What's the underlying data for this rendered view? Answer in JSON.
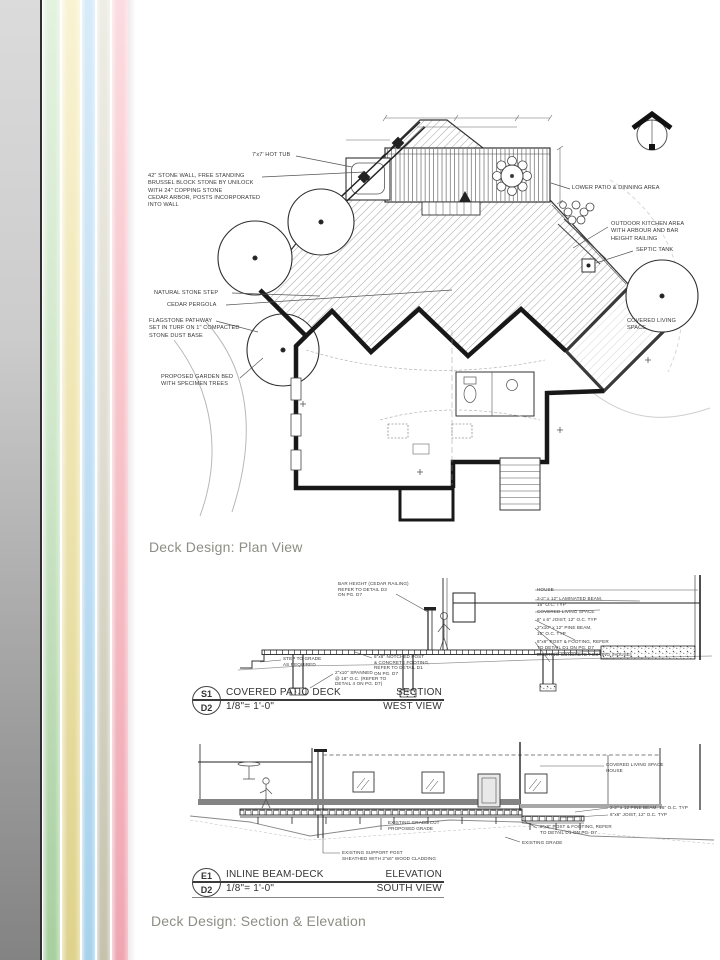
{
  "slide": {
    "background": "#ffffff"
  },
  "sidebar": {
    "panel_top_color": "#dbdbdb",
    "panel_bottom_color": "#838383",
    "divider_color": "#2f2f2f",
    "stripes": [
      {
        "name": "green",
        "top": "#e4f2e0",
        "bottom": "#a8cfa0"
      },
      {
        "name": "yellow",
        "top": "#f9f3d3",
        "bottom": "#ded28c"
      },
      {
        "name": "blue",
        "top": "#d8ebf8",
        "bottom": "#a8d2ec"
      },
      {
        "name": "beige",
        "top": "#eeede5",
        "bottom": "#c6c2ae"
      },
      {
        "name": "pink",
        "top": "#fbdce0",
        "bottom": "#efa6b2"
      }
    ]
  },
  "captions": {
    "plan": "Deck Design: Plan View",
    "section_elevation": "Deck Design: Section & Elevation",
    "color": "#8d8d85"
  },
  "plan_view": {
    "labels": {
      "hot_tub": "7'x7' HOT TUB",
      "stone_wall": "42\" STONE WALL, FREE STANDING\nBRUSSEL BLOCK STONE BY UNILOCK\nWITH 24\" COPPING STONE\nCEDAR ARBOR, POSTS INCORPORATED\nINTO WALL",
      "natural_stone_step": "NATURAL STONE STEP",
      "cedar_pergola": "CEDAR PERGOLA",
      "flagstone_pathway": "FLAGSTONE PATHWAY\nSET IN TURF ON 1\" COMPACTED\nSTONE DUST BASE",
      "garden_bed": "PROPOSED GARDEN BED\nWITH SPECIMEN TREES",
      "lower_patio": "LOWER PATIO & DINNING AREA",
      "outdoor_kitchen": "OUTDOOR KITCHEN AREA\nWITH ARBOUR AND BAR\nHEIGHT RAILING",
      "septic_tank": "SEPTIC TANK",
      "covered_living": "COVERED LIVING\nSPACE"
    }
  },
  "section_view": {
    "labels": {
      "railing": "BAR HEIGHT (CEDAR RAILING)\nREFER TO DETAIL D3\nON PG. D7",
      "step_to_grade": "STEP TO GRADE\nAS REQUIRED",
      "spans": "2\"x10\" SPANNED\n@ 16\" O.C. (REFER TO\nDETAIL 4 ON PG. D7)",
      "notched_post": "6\"x6\" NOTCHED POST\n& CONCRETE FOOTING,\nREFER TO DETAIL D1\nON PG. D7",
      "house": "HOUSE",
      "laminated_beam": "2-2\" x 12\" LAMINATED BEAM,\n16\" O.C. TYP",
      "covered_living_space": "COVERED LIVING SPACE",
      "joist": "6\" x 6\" JOIST, 12\" O.C. TYP",
      "pine_beam": "2\"x10\" x 12\" PINE BEAM,\n16\" O.C. TYP",
      "post_footing": "6\"x6\" POST & FOOTING, REFER\nTO DETAIL D1 ON PG. D7",
      "concrete_footing": "EXISTING CONCRETE FOOTING (HOUSE)"
    },
    "title_block": {
      "drawing_ref": "S1",
      "sheet_ref": "D2",
      "title": "COVERED PATIO DECK",
      "scale": "1/8\"= 1'-0\"",
      "type": "SECTION",
      "view": "WEST VIEW"
    }
  },
  "elevation_view": {
    "labels": {
      "covered_living_house": "COVERED LIVING SPACE\nHOUSE",
      "pine_beam": "2-2\" x 12 PINE BEAM, 16\" O.C. TYP",
      "joist": "6\"x6\" JOIST, 12\" O.C. TYP",
      "post_footing": "6\"x6\" POST & FOOTING, REFER\nTO DETAIL D1 ON PG. D7",
      "existing_grade": "EXISTING GRADE",
      "grade_cut": "EXISTING GRADE CUT\nPROPOSED GRADE",
      "support_post": "EXISTING SUPPORT POST\nSHEATHED WITH 2\"x6\" WOOD CLADDING"
    },
    "title_block": {
      "drawing_ref": "E1",
      "sheet_ref": "D2",
      "title": "INLINE BEAM-DECK",
      "scale": "1/8\"= 1'-0\"",
      "type": "ELEVATION",
      "view": "SOUTH VIEW"
    }
  }
}
